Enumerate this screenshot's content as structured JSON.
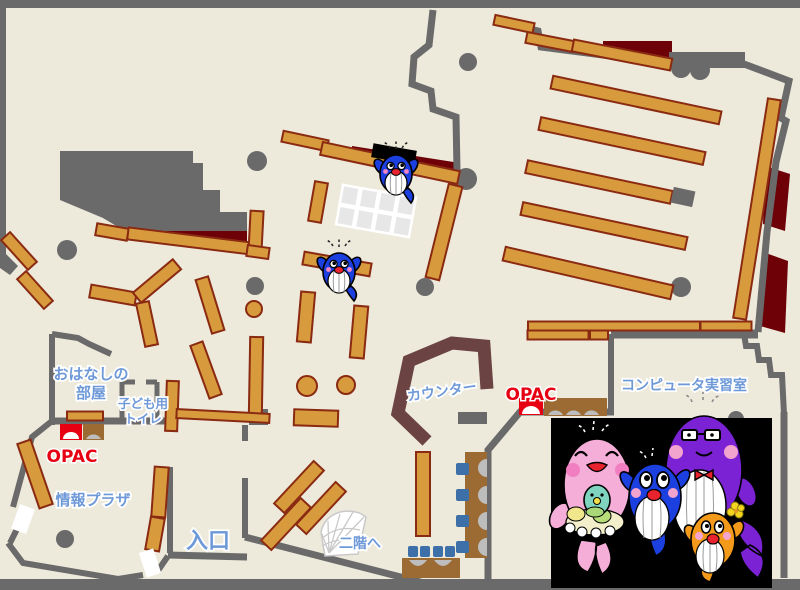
{
  "labels": {
    "storytime_room_line1": "おはなしの",
    "storytime_room_line2": "部屋",
    "kids_toilet_line1": "子ども用",
    "kids_toilet_line2": "トイレ",
    "opac_left": "OPAC",
    "opac_right": "OPAC",
    "info_plaza": "情報プラザ",
    "entrance": "入口",
    "to_second_floor": "二階へ",
    "counter": "カウンター",
    "computer_room": "コンピュータ実習室"
  },
  "colors": {
    "floor": "#edeadb",
    "wall": "#6a6a6a",
    "shelf": "#d79a3c",
    "shelf_border": "#8a2a12",
    "dark_red": "#6e0008",
    "counter": "#6b4343",
    "desk_brown": "#9c6b34",
    "chair_blue": "#3d6fa8",
    "seat_gray": "#bdbdbd",
    "label_blue": "#6e99d8",
    "opac_red": "#e60012",
    "photo_black": "#000000",
    "stair_line": "#c9c9c9",
    "grid_cell": "#e7e7e7",
    "mascot_blue": "#1c3fe0",
    "mascot_pink": "#f5aed8",
    "mascot_purple": "#7b22d4",
    "mascot_orange": "#f39a1b",
    "mascot_teal": "#7fd4c0"
  }
}
